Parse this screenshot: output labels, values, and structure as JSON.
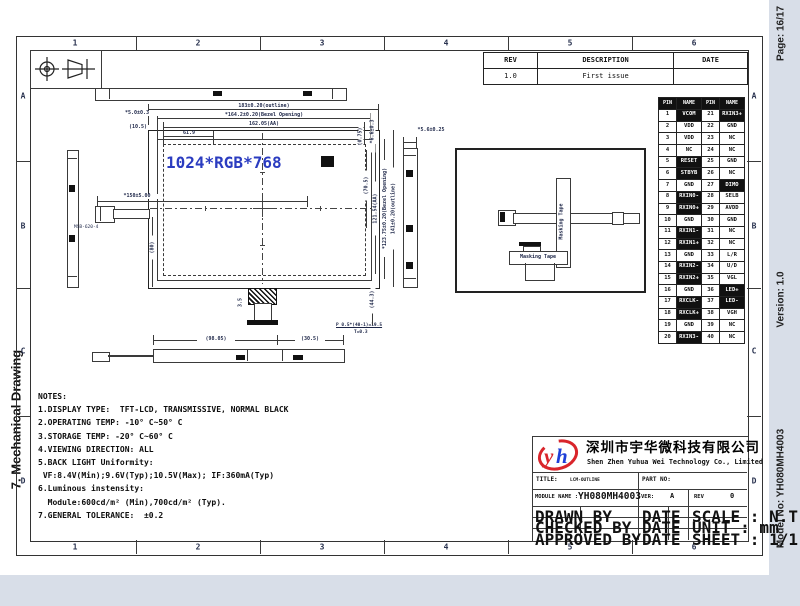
{
  "page": {
    "section_label": "7. Mechanical Drawing",
    "page_label": "Page: 16/17",
    "version_label": "Version: 1.0",
    "model_label": "Model No: YH080MH4003"
  },
  "frame": {
    "column_numbers": [
      "1",
      "2",
      "3",
      "4",
      "5",
      "6"
    ],
    "row_letters": [
      "A",
      "B",
      "C",
      "D"
    ]
  },
  "rev_table": {
    "headers": [
      "REV",
      "DESCRIPTION",
      "DATE"
    ],
    "rows": [
      [
        "1.0",
        "First issue",
        ""
      ]
    ]
  },
  "pin_table": {
    "headers": [
      "PIN",
      "NAME",
      "PIN",
      "NAME"
    ],
    "rows": [
      {
        "l_pin": "1",
        "l_name": "VCOM",
        "l_hl": true,
        "r_pin": "21",
        "r_name": "RXIN3+",
        "r_hl": true
      },
      {
        "l_pin": "2",
        "l_name": "VDD",
        "l_hl": false,
        "r_pin": "22",
        "r_name": "GND",
        "r_hl": false
      },
      {
        "l_pin": "3",
        "l_name": "VDD",
        "l_hl": false,
        "r_pin": "23",
        "r_name": "NC",
        "r_hl": false
      },
      {
        "l_pin": "4",
        "l_name": "NC",
        "l_hl": false,
        "r_pin": "24",
        "r_name": "NC",
        "r_hl": false
      },
      {
        "l_pin": "5",
        "l_name": "RESET",
        "l_hl": true,
        "r_pin": "25",
        "r_name": "GND",
        "r_hl": false
      },
      {
        "l_pin": "6",
        "l_name": "STBYB",
        "l_hl": true,
        "r_pin": "26",
        "r_name": "NC",
        "r_hl": false
      },
      {
        "l_pin": "7",
        "l_name": "GND",
        "l_hl": false,
        "r_pin": "27",
        "r_name": "DIMO",
        "r_hl": true
      },
      {
        "l_pin": "8",
        "l_name": "RXIN0-",
        "l_hl": true,
        "r_pin": "28",
        "r_name": "SELB",
        "r_hl": false
      },
      {
        "l_pin": "9",
        "l_name": "RXIN0+",
        "l_hl": true,
        "r_pin": "29",
        "r_name": "AVDD",
        "r_hl": false
      },
      {
        "l_pin": "10",
        "l_name": "GND",
        "l_hl": false,
        "r_pin": "30",
        "r_name": "GND",
        "r_hl": false
      },
      {
        "l_pin": "11",
        "l_name": "RXIN1-",
        "l_hl": true,
        "r_pin": "31",
        "r_name": "NC",
        "r_hl": false
      },
      {
        "l_pin": "12",
        "l_name": "RXIN1+",
        "l_hl": true,
        "r_pin": "32",
        "r_name": "NC",
        "r_hl": false
      },
      {
        "l_pin": "13",
        "l_name": "GND",
        "l_hl": false,
        "r_pin": "33",
        "r_name": "L/R",
        "r_hl": false
      },
      {
        "l_pin": "14",
        "l_name": "RXIN2-",
        "l_hl": true,
        "r_pin": "34",
        "r_name": "U/D",
        "r_hl": false
      },
      {
        "l_pin": "15",
        "l_name": "RXIN2+",
        "l_hl": true,
        "r_pin": "35",
        "r_name": "VGL",
        "r_hl": false
      },
      {
        "l_pin": "16",
        "l_name": "GND",
        "l_hl": false,
        "r_pin": "36",
        "r_name": "LED+",
        "r_hl": true
      },
      {
        "l_pin": "17",
        "l_name": "RXCLK-",
        "l_hl": true,
        "r_pin": "37",
        "r_name": "LED-",
        "r_hl": true
      },
      {
        "l_pin": "18",
        "l_name": "RXCLK+",
        "l_hl": true,
        "r_pin": "38",
        "r_name": "VGH",
        "r_hl": false
      },
      {
        "l_pin": "19",
        "l_name": "GND",
        "l_hl": false,
        "r_pin": "39",
        "r_name": "NC",
        "r_hl": false
      },
      {
        "l_pin": "20",
        "l_name": "RXIN3-",
        "l_hl": true,
        "r_pin": "40",
        "r_name": "NC",
        "r_hl": false
      }
    ]
  },
  "drawing": {
    "dims": {
      "outline_w": "183±0.20(outline)",
      "bezel_w": "*164.2±0.20(Bezel Opening)",
      "aa_w": "162.05(AA)",
      "d61": "61.9",
      "d50": "*5.0±0.3",
      "d105": "(10.5)",
      "d075": "(0.75)",
      "d66": "*6.6±0.3",
      "d705": "(70.5)",
      "aa_h": "121.54(AA)",
      "bezel_h": "*123.75±0.20(Bezel Opening)",
      "outline_h": "141±0.20(outline)",
      "d56": "*5.6±0.25",
      "d150": "*150±5.00",
      "d80": "(80)",
      "d35": "3.5",
      "d9805": "(98.05)",
      "d305": "(30.5)",
      "pitch": "P 0.5*(40-1)=19.5",
      "thick": "T=0.3",
      "d443": "(44.3)"
    },
    "labels": {
      "resolution": "1024*RGB*768",
      "masking_tape": "Masking Tape",
      "connector_code": "MSB-620-4"
    }
  },
  "notes": {
    "lines": [
      "NOTES:",
      "1.DISPLAY TYPE:  TFT-LCD, TRANSMISSIVE, NORMAL BLACK",
      "2.OPERATING TEMP: -10° C~50° C",
      "3.STORAGE TEMP: -20° C~60° C",
      "4.VIEWING DIRECTION: ALL",
      "5.BACK LIGHT Uniformity:",
      " VF:8.4V(Min);9.6V(Typ);10.5V(Max); IF:360mA(Typ)",
      "6.Luminous instensity:",
      "  Module:600cd/m² (Min),700cd/m² (Typ).",
      "7.GENERAL TOLERANCE:  ±0.2"
    ]
  },
  "title_block": {
    "logo_text": "yh",
    "company_cn": "深圳市宇华微科技有限公司",
    "company_en": "Shen Zhen Yuhua Wei Technology Co., Limited",
    "title_label": "TITLE:",
    "title_value": "LCM-OUTLINE",
    "part_no_label": "PART NO:",
    "module_name_label": "MODULE NAME :",
    "module_name_value": "YH080MH4003",
    "ver_label": "VER:",
    "ver_value": "A",
    "rev_label": "REV",
    "rev_value": "0",
    "drawn_label": "DRAWN BY",
    "checked_label": "CHECKED BY",
    "approved_label": "APPROVED BY",
    "date_label": "DATE",
    "scale_label": "SCALE : N.T.S.",
    "unit_label": "UNIT : mm",
    "sheet_label": "SHEET : 1/1"
  },
  "colors": {
    "background": "#d8dee8",
    "line": "#3a3a3a",
    "dim_text": "#1c2547",
    "resolution_text": "#2b3cc0",
    "logo_red": "#d9252b",
    "logo_blue": "#1e3fd8",
    "highlight_cell": "#111111"
  }
}
